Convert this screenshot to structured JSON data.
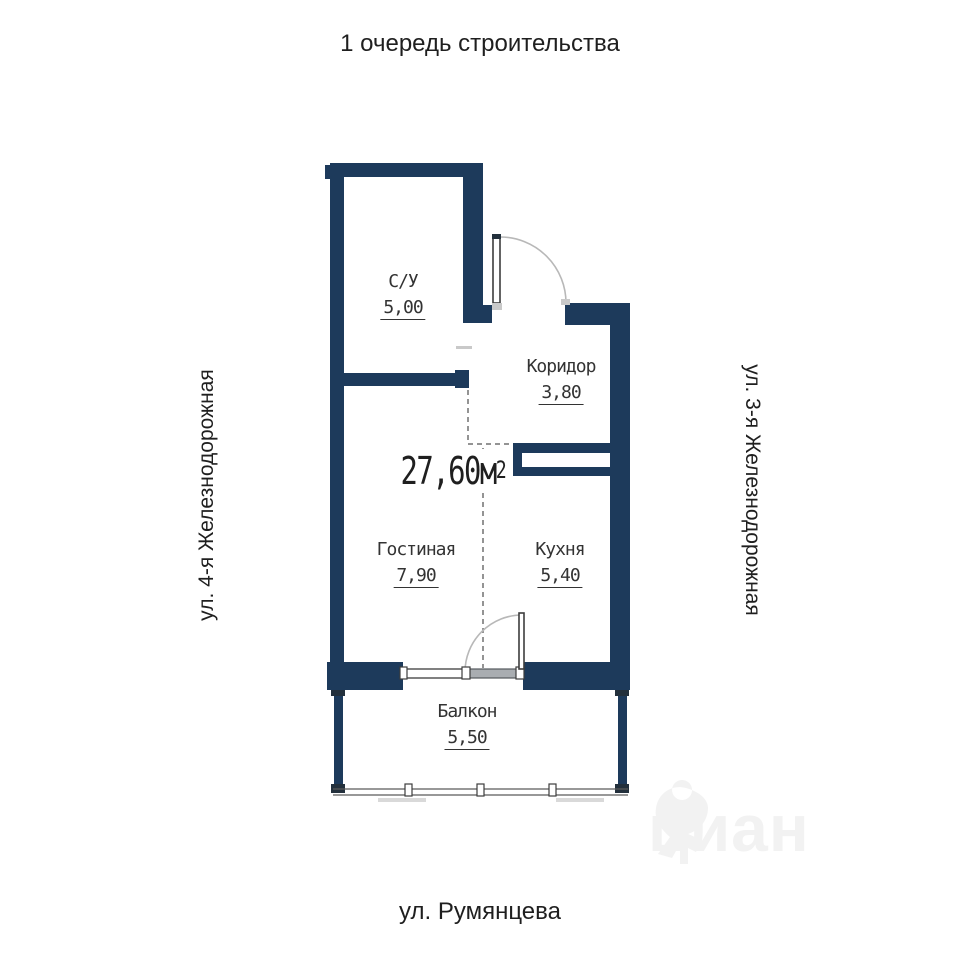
{
  "colors": {
    "wall": "#1d3a5b",
    "text": "#1f1f1f",
    "label": "#333333",
    "dash": "#707070",
    "watermark": "#f2f2f2"
  },
  "header": {
    "title": "1 очередь строительства"
  },
  "streets": {
    "left": "ул. 4-я Железнодорожная",
    "right": "ул. 3-я Железнодорожная",
    "bottom": "ул. Румянцева"
  },
  "plan": {
    "total_area": "27,60м",
    "total_area_sup": "2",
    "rooms": [
      {
        "name": "С/У",
        "area": "5,00"
      },
      {
        "name": "Коридор",
        "area": "3,80"
      },
      {
        "name": "Гостиная",
        "area": "7,90"
      },
      {
        "name": "Кухня",
        "area": "5,40"
      },
      {
        "name": "Балкон",
        "area": "5,50"
      }
    ]
  },
  "watermark": {
    "text": "циан",
    "icon": "cian-pin-logo"
  }
}
